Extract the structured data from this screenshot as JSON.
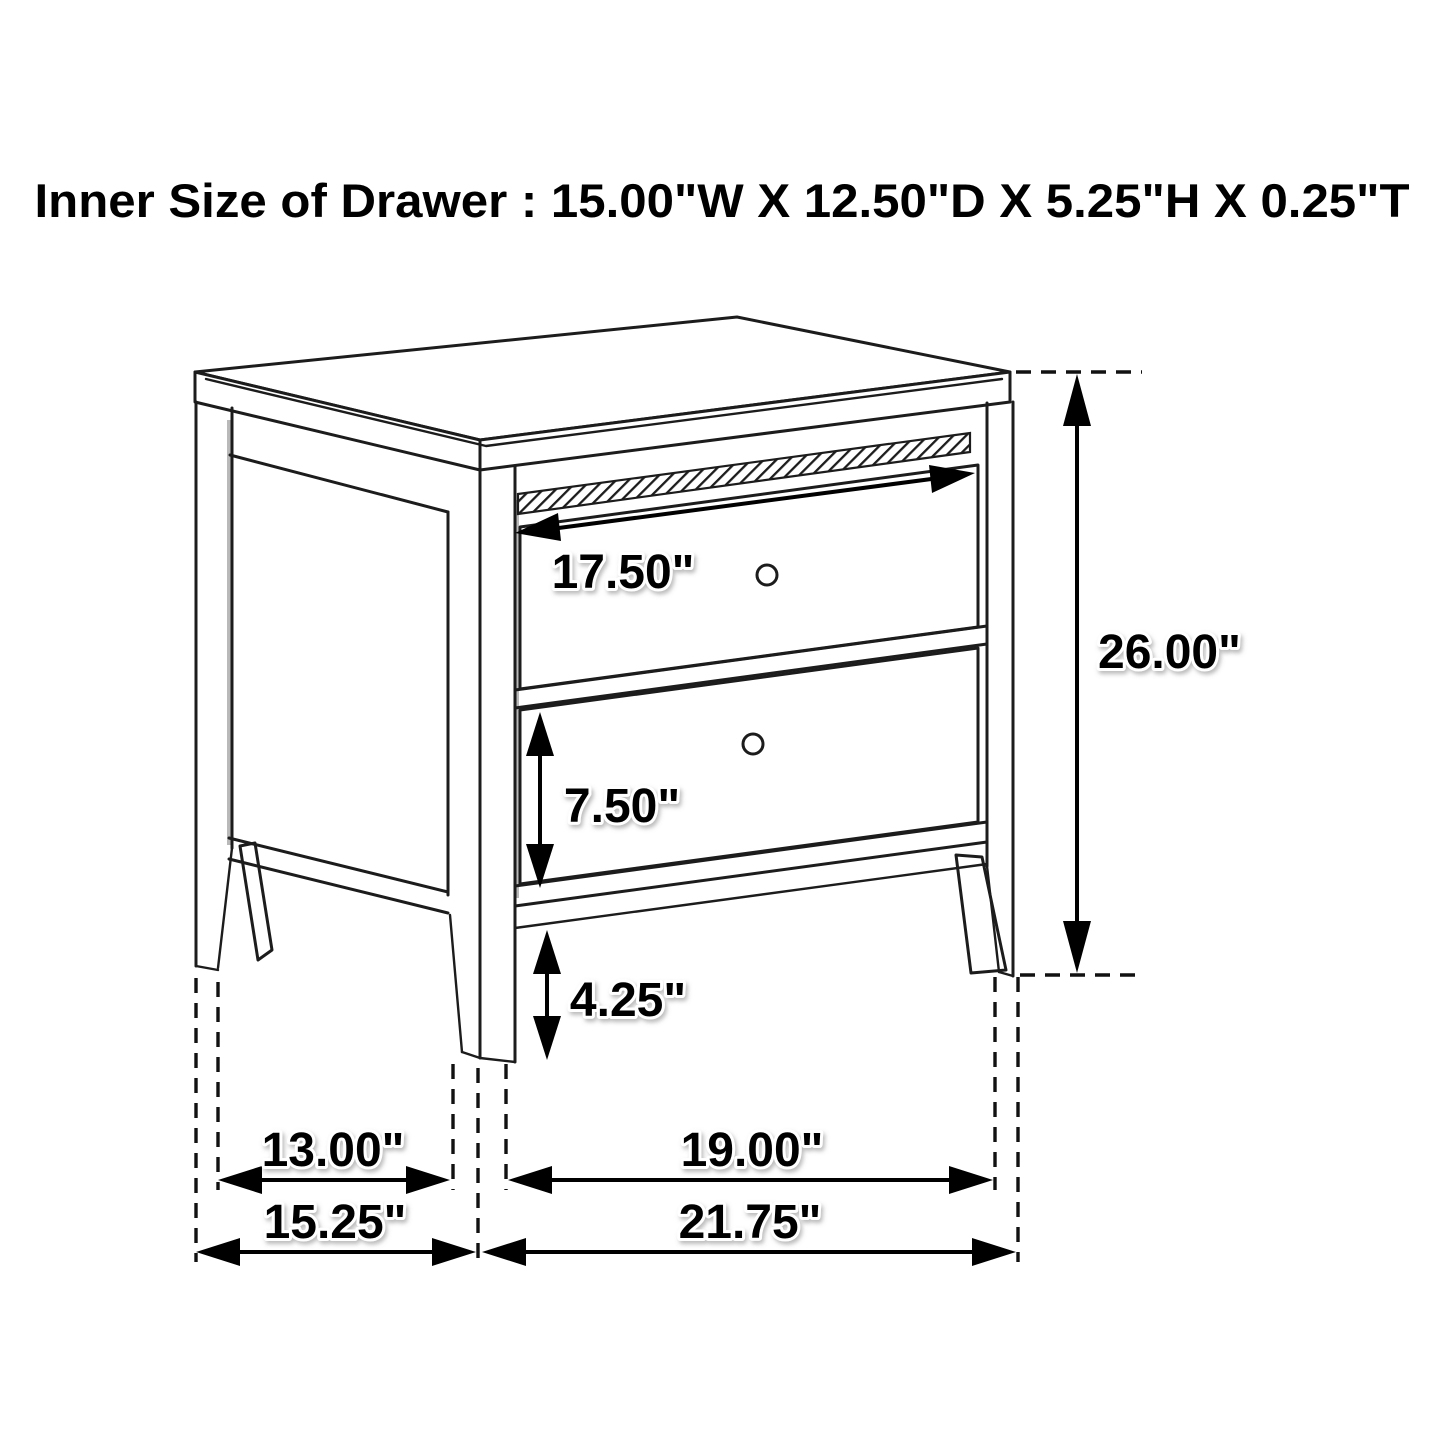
{
  "page": {
    "background": "#ffffff",
    "ink_color": "#1c1c1c",
    "accent_color": "#000000"
  },
  "title": {
    "text": "Inner Size of Drawer : 15.00\"W X 12.50\"D X 5.25\"H X 0.25\"T"
  },
  "figure": {
    "type": "furniture-dimension-diagram",
    "subject": "two-drawer nightstand line drawing with dimension callouts",
    "labels": {
      "drawer_face_width": "17.50\"",
      "overall_height": "26.00\"",
      "lower_drawer_height": "7.50\"",
      "leg_height": "4.25\"",
      "side_leg_span": "13.00\"",
      "front_leg_span": "19.00\"",
      "overall_depth": "15.25\"",
      "overall_width": "21.75\""
    },
    "inner_drawer_size": {
      "width": "15.00\"W",
      "depth": "12.50\"D",
      "height": "5.25\"H",
      "thickness": "0.25\"T"
    }
  }
}
